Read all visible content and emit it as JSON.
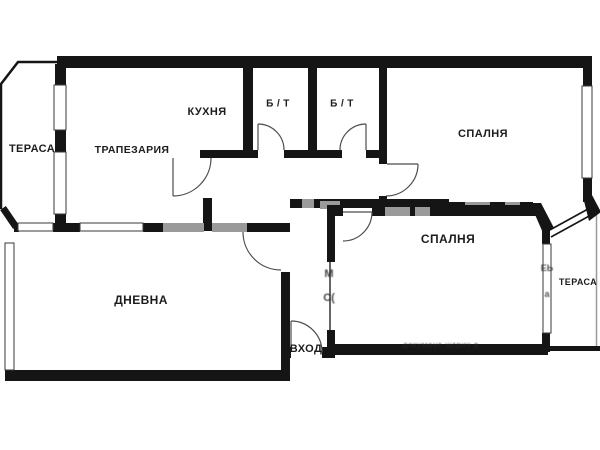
{
  "plan": {
    "type": "apartment-floor-plan",
    "rooms": [
      {
        "id": "terrace-left",
        "label": "ТЕРАСА"
      },
      {
        "id": "dining",
        "label": "ТРАПЕЗАРИЯ"
      },
      {
        "id": "kitchen",
        "label": "КУХНЯ"
      },
      {
        "id": "bath1",
        "label": "Б / Т"
      },
      {
        "id": "bath2",
        "label": "Б / Т"
      },
      {
        "id": "bedroom1",
        "label": "СПАЛНЯ"
      },
      {
        "id": "living",
        "label": "ДНЕВНА"
      },
      {
        "id": "bedroom2",
        "label": "СПАЛНЯ"
      },
      {
        "id": "terrace-right",
        "label": "ТЕРАСА"
      },
      {
        "id": "entrance",
        "label": "ВХОД"
      }
    ],
    "watermarks": {
      "bottom": "документ щтрих в .........",
      "corridor_vertical": "МС(",
      "terrace_vertical": "ЕЬа"
    },
    "colors": {
      "wall": "#151515",
      "wall_light": "#9a9a9a",
      "background": "#ffffff",
      "label_text": "#1c1c1c"
    }
  }
}
